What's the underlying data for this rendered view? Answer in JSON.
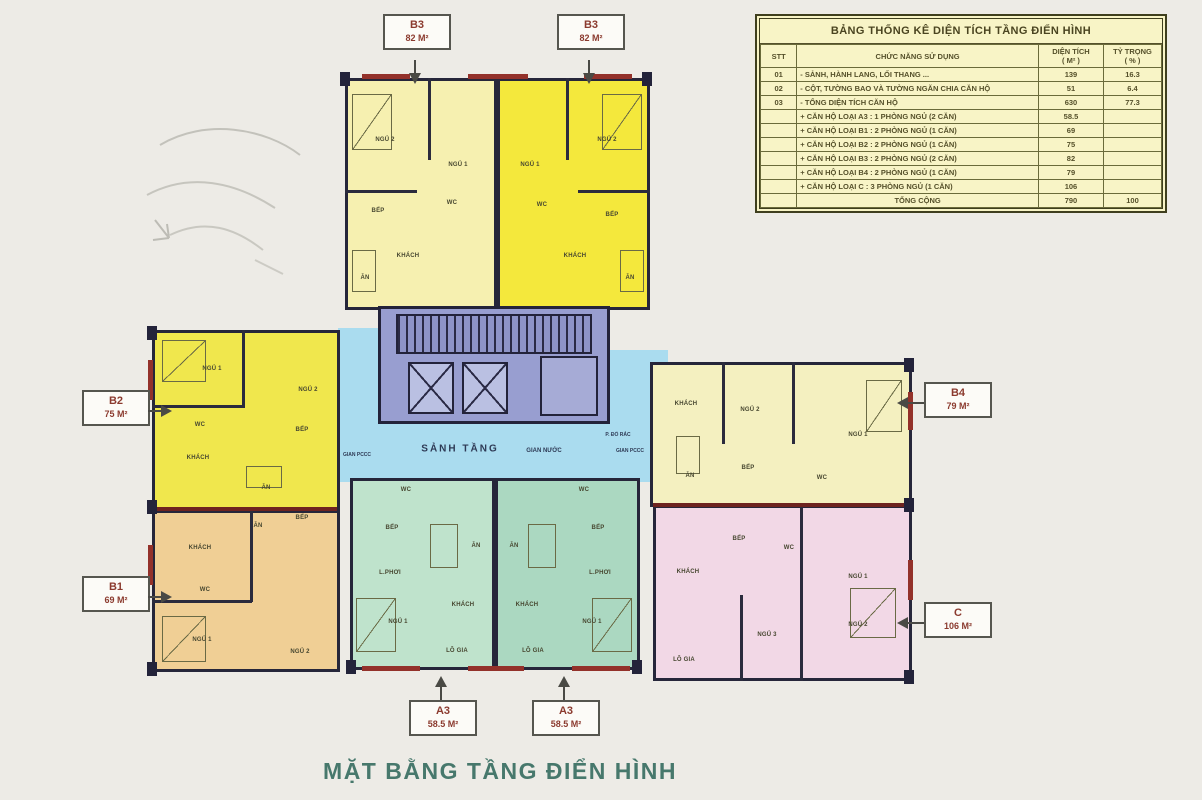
{
  "title": "MẶT BẰNG TẦNG ĐIỂN HÌNH",
  "table": {
    "title": "BẢNG THỐNG KÊ DIỆN TÍCH TẦNG ĐIỂN HÌNH",
    "headers": {
      "stt": "STT",
      "func": "CHỨC NĂNG SỬ DỤNG",
      "area1": "DIỆN TÍCH",
      "area2": "( M² )",
      "pct1": "TỶ TRỌNG",
      "pct2": "( % )"
    },
    "rows": [
      {
        "stt": "01",
        "func": "- SẢNH, HÀNH LANG, LỐI THANG ...",
        "area": "139",
        "pct": "16.3"
      },
      {
        "stt": "02",
        "func": "- CỘT, TƯỜNG BAO VÀ TƯỜNG NGĂN CHIA CĂN HỘ",
        "area": "51",
        "pct": "6.4"
      },
      {
        "stt": "03",
        "func": "- TỔNG DIỆN TÍCH CĂN HỘ",
        "area": "630",
        "pct": "77.3"
      },
      {
        "stt": "",
        "func": "+ CĂN HỘ LOẠI A3 : 1 PHÒNG NGỦ (2 CĂN)",
        "area": "58.5",
        "pct": ""
      },
      {
        "stt": "",
        "func": "+ CĂN HỘ LOẠI B1 : 2 PHÒNG NGỦ (1 CĂN)",
        "area": "69",
        "pct": ""
      },
      {
        "stt": "",
        "func": "+ CĂN HỘ LOẠI B2 : 2 PHÒNG NGỦ (1 CĂN)",
        "area": "75",
        "pct": ""
      },
      {
        "stt": "",
        "func": "+ CĂN HỘ LOẠI B3 : 2 PHÒNG NGỦ (2 CĂN)",
        "area": "82",
        "pct": ""
      },
      {
        "stt": "",
        "func": "+ CĂN HỘ LOẠI B4 : 2 PHÒNG NGỦ (1 CĂN)",
        "area": "79",
        "pct": ""
      },
      {
        "stt": "",
        "func": "+ CĂN HỘ LOẠI C : 3 PHÒNG NGỦ (1 CĂN)",
        "area": "106",
        "pct": ""
      },
      {
        "stt": "",
        "func": "TỔNG CỘNG",
        "area": "790",
        "pct": "100"
      }
    ]
  },
  "callouts": {
    "b3a": {
      "code": "B3",
      "area": "82 M²"
    },
    "b3b": {
      "code": "B3",
      "area": "82 M²"
    },
    "b2": {
      "code": "B2",
      "area": "75 M²"
    },
    "b1": {
      "code": "B1",
      "area": "69 M²"
    },
    "b4": {
      "code": "B4",
      "area": "79 M²"
    },
    "c": {
      "code": "C",
      "area": "106 M²"
    },
    "a3a": {
      "code": "A3",
      "area": "58.5 M²"
    },
    "a3b": {
      "code": "A3",
      "area": "58.5 M²"
    }
  },
  "core": {
    "lobby": "SẢNH TẦNG",
    "gian_nuoc": "GIAN NƯỚC",
    "gian_pccc_left": "GIAN PCCC",
    "gian_pccc_right": "GIAN PCCC",
    "p_do_rac": "P. ĐỔ RÁC"
  },
  "rooms": {
    "b3l": {
      "ngu2": "NGỦ 2",
      "ngu1": "NGỦ 1",
      "bep": "BẾP",
      "wc": "WC",
      "khach": "KHÁCH",
      "an": "ĂN"
    },
    "b3r": {
      "ngu1": "NGỦ 1",
      "ngu2": "NGỦ 2",
      "bep": "BẾP",
      "wc": "WC",
      "khach": "KHÁCH",
      "an": "ĂN"
    },
    "b2": {
      "ngu1": "NGỦ 1",
      "ngu2": "NGỦ 2",
      "wc": "WC",
      "bep": "BẾP",
      "khach": "KHÁCH",
      "an": "ĂN"
    },
    "b1": {
      "khach": "KHÁCH",
      "an": "ĂN",
      "bep": "BẾP",
      "wc": "WC",
      "ngu1": "NGỦ 1",
      "ngu2": "NGỦ 2"
    },
    "b4": {
      "khach": "KHÁCH",
      "ngu2": "NGỦ 2",
      "ngu1": "NGỦ 1",
      "an": "ĂN",
      "bep": "BẾP",
      "wc": "WC"
    },
    "c": {
      "bep": "BẾP",
      "khach": "KHÁCH",
      "wc": "WC",
      "ngu1": "NGỦ 1",
      "ngu2": "NGỦ 2",
      "ngu3": "NGỦ 3",
      "logia": "LÔ GIA"
    },
    "a3l": {
      "wc": "WC",
      "bep": "BẾP",
      "an": "ĂN",
      "lphoi": "L.PHƠI",
      "khach": "KHÁCH",
      "ngu": "NGỦ 1",
      "logia": "LÔ GIA"
    },
    "a3r": {
      "wc": "WC",
      "bep": "BẾP",
      "an": "ĂN",
      "lphoi": "L.PHƠI",
      "khach": "KHÁCH",
      "ngu": "NGỦ 1",
      "logia": "LÔ GIA"
    }
  },
  "colors": {
    "b3_left": "#f6f0b0",
    "b3_right": "#f4e83c",
    "b2": "#f0e74d",
    "b1": "#f0cf95",
    "b4": "#f4f0c0",
    "c": "#f2d8e6",
    "a3_left": "#bfe3cc",
    "a3_right": "#abd8c1",
    "core": "#989ed0",
    "lobby": "#aadcef",
    "table_bg": "#f8f4c6",
    "title_text": "#47786c",
    "callout_text": "#8b3a2e",
    "wall": "#26263a",
    "wall_accent": "#93312a"
  }
}
